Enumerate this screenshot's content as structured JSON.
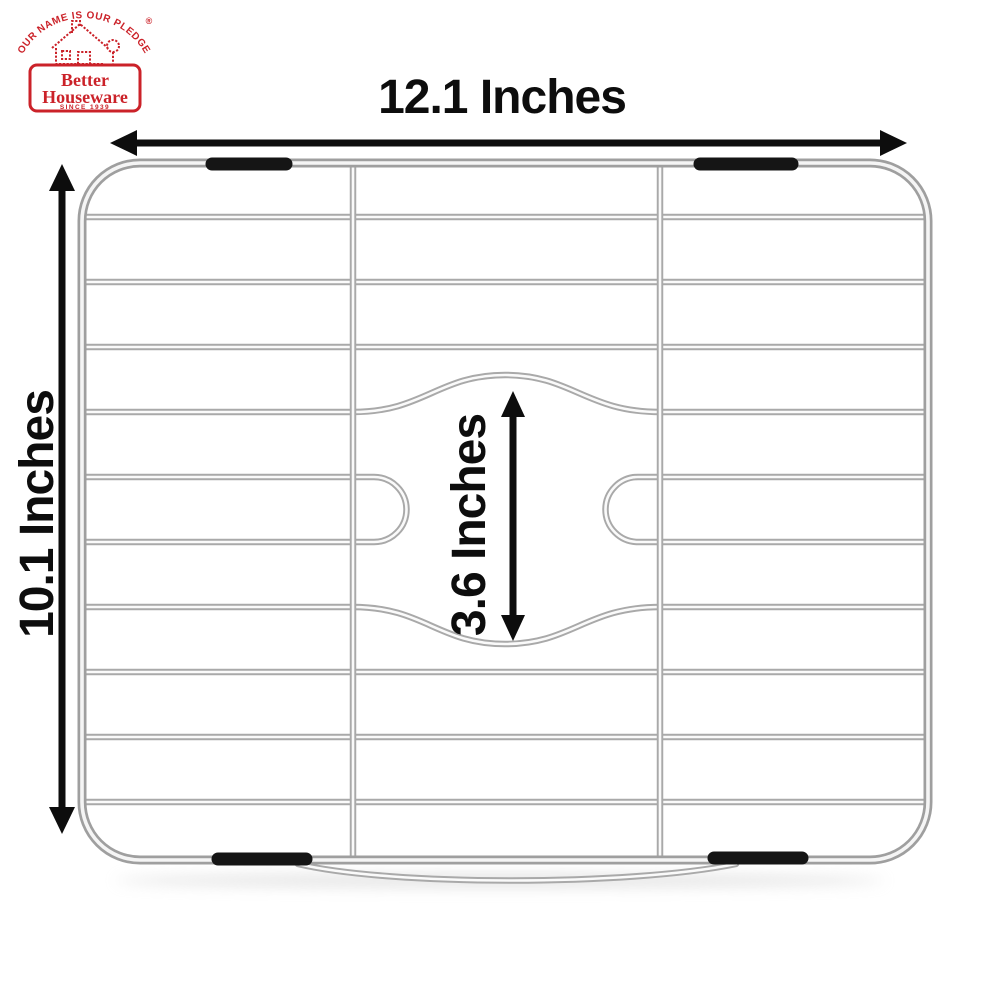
{
  "brand": {
    "pledge": "\"OUR NAME IS OUR PLEDGE\"",
    "registered": "®",
    "name_top": "Better",
    "name_bottom": "Houseware",
    "since": "SINCE 1939",
    "color": "#cb2229"
  },
  "dimensions": {
    "width": "12.1 Inches",
    "height": "10.1 Inches",
    "drain_opening": "3.6 Inches"
  },
  "style": {
    "background": "#ffffff",
    "wire_color": "#a9a9a9",
    "wire_highlight": "#fafafa",
    "bumper_color": "#151515",
    "annotation_color": "#0d0d0d"
  }
}
